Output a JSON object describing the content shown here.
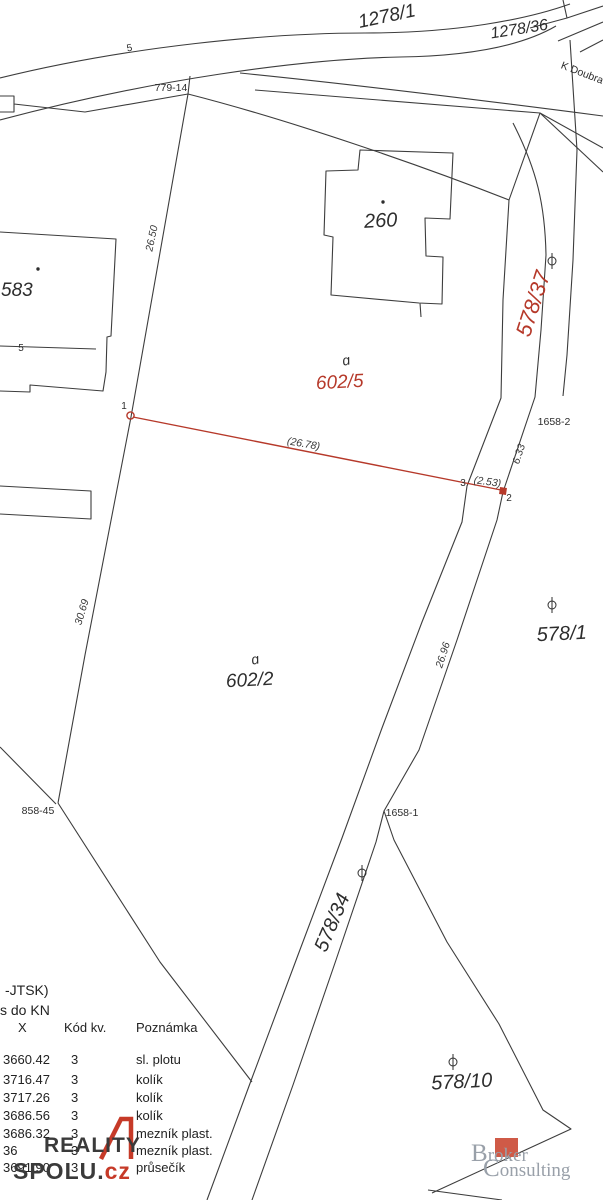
{
  "colors": {
    "accent_red": "#b6392a",
    "line_color": "#3d3d3d",
    "logo_dark": "#3a3a3a",
    "logo_red": "#c63a28",
    "broker_red": "#cf5a47",
    "broker_gray": "#99a0a9"
  },
  "map": {
    "street_label": "K Doubra",
    "symbols": {
      "fence": "5",
      "courtyard": "ɑ"
    },
    "parcels": [
      {
        "label": "1278/1"
      },
      {
        "label": "1278/36"
      },
      {
        "label": "583"
      },
      {
        "label": "260"
      },
      {
        "label": "602/5",
        "color": "red"
      },
      {
        "label": "578/37",
        "color": "red"
      },
      {
        "label": "602/2"
      },
      {
        "label": "578/1"
      },
      {
        "label": "578/34"
      },
      {
        "label": "578/10"
      }
    ],
    "boundary_points": [
      {
        "label": "779-14"
      },
      {
        "label": "1658-2"
      },
      {
        "label": "1658-1"
      },
      {
        "label": "858-45"
      }
    ],
    "survey_points": [
      {
        "label": "1"
      },
      {
        "label": "2"
      },
      {
        "label": "3"
      }
    ],
    "measurements": [
      {
        "label": "26.50"
      },
      {
        "label": "(26.78)"
      },
      {
        "label": "6.33"
      },
      {
        "label": "(2.53)"
      },
      {
        "label": "30.69"
      },
      {
        "label": "26.96"
      }
    ]
  },
  "table": {
    "line1": "-JTSK)",
    "line2": "s do KN",
    "col_x": "X",
    "col_kod": "Kód kv.",
    "col_note": "Poznámka",
    "rows": [
      {
        "x": "3660.42",
        "kod": "3",
        "note": "sl. plotu"
      },
      {
        "x": "3716.47",
        "kod": "3",
        "note": "kolík"
      },
      {
        "x": "3717.26",
        "kod": "3",
        "note": "kolík"
      },
      {
        "x": "3686.56",
        "kod": "3",
        "note": "kolík"
      },
      {
        "x": "3686.32",
        "kod": "3",
        "note": "mezník plast."
      },
      {
        "x": "36",
        "kod": "3",
        "note": "mezník plast."
      },
      {
        "x": "3691.90",
        "kod": "3",
        "note": "průsečík"
      }
    ]
  },
  "logos": {
    "reality": {
      "line1": "REALITY",
      "line2": "SPOLU.",
      "tld": "cz"
    },
    "broker": {
      "line1": "Broker",
      "line2": "Consulting"
    }
  }
}
